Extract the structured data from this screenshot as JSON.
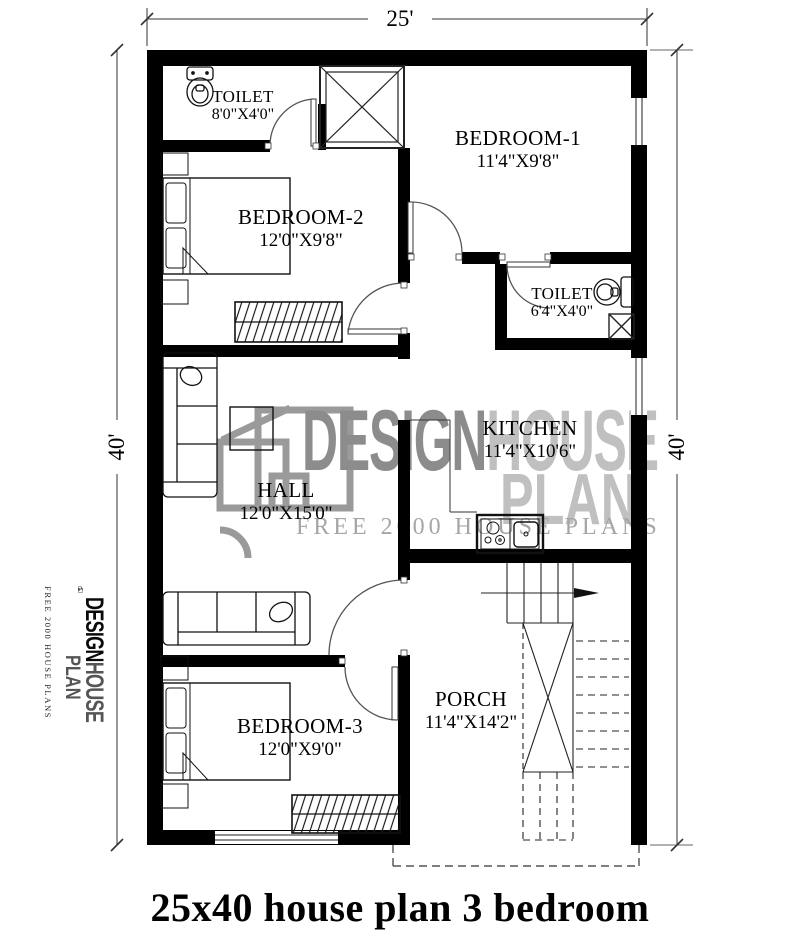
{
  "title": "25x40 house plan 3 bedroom",
  "dimensions": {
    "width_top": "25'",
    "height_left": "40'",
    "height_right": "40'"
  },
  "rooms": [
    {
      "name": "TOILET",
      "size": "8'0\"X4'0\""
    },
    {
      "name": "BEDROOM-1",
      "size": "11'4\"X9'8\""
    },
    {
      "name": "BEDROOM-2",
      "size": "12'0\"X9'8\""
    },
    {
      "name": "TOILET",
      "size": "6'4\"X4'0\""
    },
    {
      "name": "KITCHEN",
      "size": "11'4\"X10'6\""
    },
    {
      "name": "HALL",
      "size": "12'0\"X15'0\""
    },
    {
      "name": "BEDROOM-3",
      "size": "12'0\"X9'0\""
    },
    {
      "name": "PORCH",
      "size": "11'4\"X14'2\""
    }
  ],
  "watermark": {
    "word1": "DESIGN",
    "word2": "HOUSE",
    "word3": "PLAN",
    "tagline": "FREE 2000 HOUSE PLANS"
  },
  "logo": {
    "word1": "DESIGN",
    "word2": "HOUSE",
    "word3": "PLAN",
    "tagline": "FREE 2000 HOUSE PLANS"
  },
  "colors": {
    "wall": "#000000",
    "thin_line": "#2a2a2a",
    "watermark_dark": "#8c8c8c",
    "watermark_light": "#c0c0c0",
    "watermark_tagline": "#a6a6a6"
  }
}
